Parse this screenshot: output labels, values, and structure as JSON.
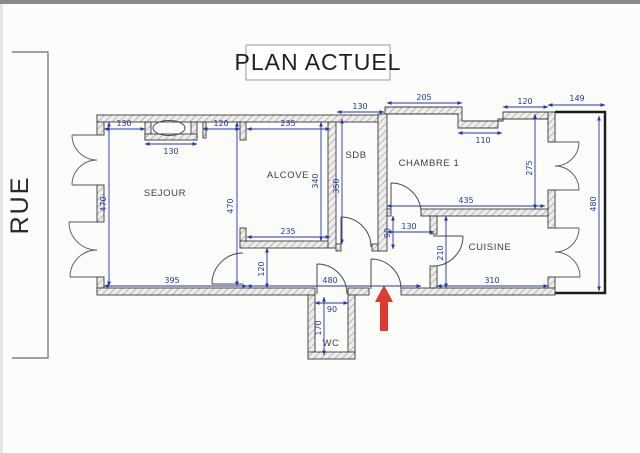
{
  "title": "PLAN ACTUEL",
  "street_label": "RUE",
  "rooms": {
    "sejour": "SEJOUR",
    "alcove": "ALCOVE",
    "sdb": "SDB",
    "chambre": "CHAMBRE 1",
    "cuisine": "CUISINE",
    "wc": "WC"
  },
  "dims": {
    "sejour_top": "130",
    "cheminee_width": "130",
    "sejour_top_right": "120",
    "alcove_top": "235",
    "sdb_top": "130",
    "chambre_top_left": "205",
    "chambre_notch": "110",
    "chambre_top_right": "120",
    "balcon_width": "149",
    "alcove_bottom": "235",
    "sejour_bottom": "395",
    "couloir_length": "480",
    "wc_width": "90",
    "hall_width": "130",
    "chambre_bottom": "435",
    "cuisine_bottom": "310",
    "sejour_height": "470",
    "alcove_height_left": "470",
    "alcove_height_right": "340",
    "sdb_height": "350",
    "chambre_height": "275",
    "balcon_height": "480",
    "hall_height": "90",
    "cuisine_height": "210",
    "couloir_width": "120",
    "wc_height": "170"
  },
  "colors": {
    "dimension_blue": "#2136a8",
    "wall_dark": "#3a3a3a",
    "arrow_red": "#e0392e",
    "scan_border_gray": "#8a8a8a"
  }
}
